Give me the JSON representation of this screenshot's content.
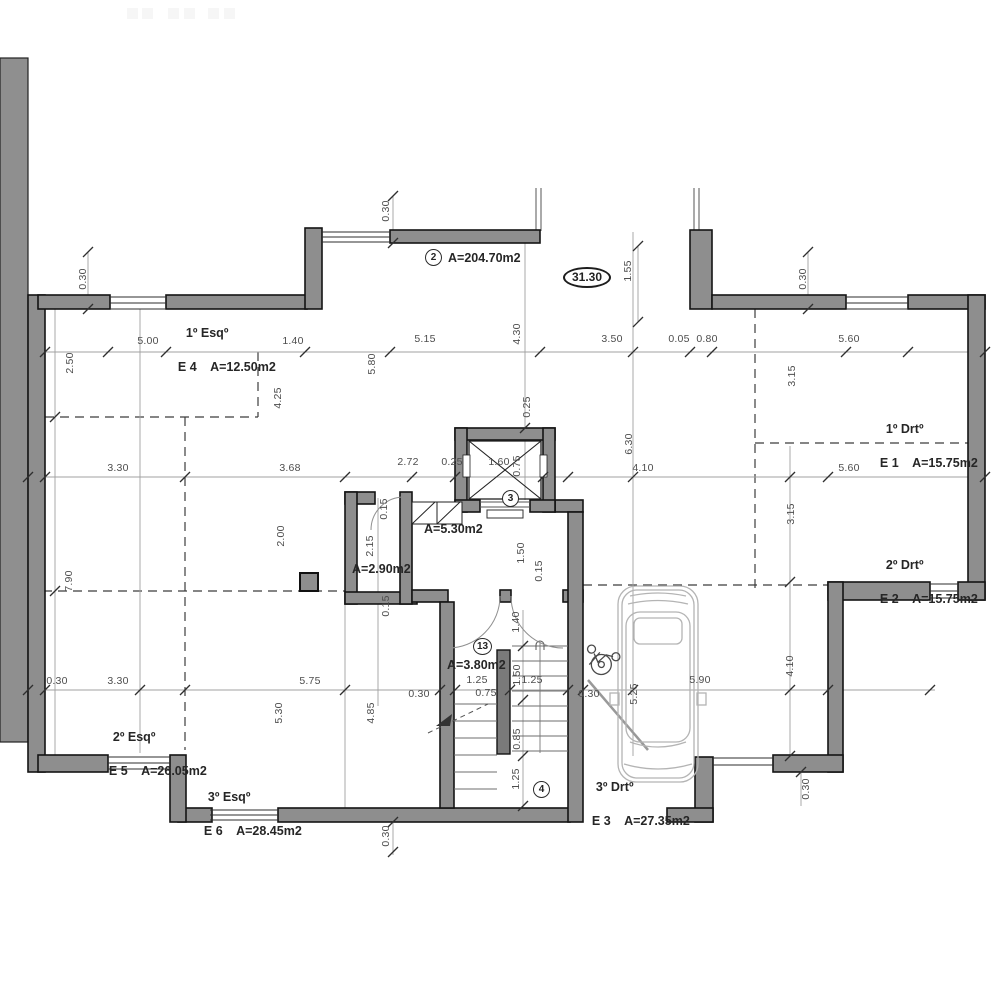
{
  "drawing": {
    "level_marker": "31.30",
    "zones": {
      "zone2": {
        "num": "2",
        "area": "A=204.70m2"
      },
      "zone3": {
        "num": "3"
      },
      "zone4": {
        "num": "4"
      },
      "zone13": {
        "num": "13",
        "area": "A=3.80m2"
      }
    },
    "rooms": {
      "hall": "A=5.30m2",
      "wc": "A=2.90m2"
    },
    "units": {
      "e1": {
        "floor": "1º Drtº",
        "label": "E 1    A=15.75m2"
      },
      "e2": {
        "floor": "2º Drtº",
        "label": "E 2    A=15.75m2"
      },
      "e3": {
        "floor": "3º Drtº",
        "label": "E 3    A=27.35m2"
      },
      "e4": {
        "floor": "1º Esqº",
        "label": "E 4    A=12.50m2"
      },
      "e5": {
        "floor": "2º Esqº",
        "label": "E 5    A=26.05m2"
      },
      "e6": {
        "floor": "3º Esqº",
        "label": "E 6    A=28.45m2"
      }
    },
    "dimensions": [
      {
        "t": "5.00",
        "x": 148,
        "y": 341
      },
      {
        "t": "1.40",
        "x": 293,
        "y": 341
      },
      {
        "t": "5.15",
        "x": 425,
        "y": 339
      },
      {
        "t": "3.50",
        "x": 612,
        "y": 339
      },
      {
        "t": "0.05",
        "x": 679,
        "y": 339
      },
      {
        "t": "0.80",
        "x": 707,
        "y": 339
      },
      {
        "t": "5.60",
        "x": 849,
        "y": 339
      },
      {
        "t": "3.30",
        "x": 118,
        "y": 468
      },
      {
        "t": "3.68",
        "x": 290,
        "y": 468
      },
      {
        "t": "2.72",
        "x": 408,
        "y": 462
      },
      {
        "t": "0.25",
        "x": 452,
        "y": 462
      },
      {
        "t": "1.60",
        "x": 499,
        "y": 462
      },
      {
        "t": "4.10",
        "x": 643,
        "y": 468
      },
      {
        "t": "5.60",
        "x": 849,
        "y": 468
      },
      {
        "t": "0.30",
        "x": 57,
        "y": 681
      },
      {
        "t": "3.30",
        "x": 118,
        "y": 681
      },
      {
        "t": "5.75",
        "x": 310,
        "y": 681
      },
      {
        "t": "0.30",
        "x": 419,
        "y": 694
      },
      {
        "t": "1.25",
        "x": 477,
        "y": 680
      },
      {
        "t": "0.75",
        "x": 486,
        "y": 693
      },
      {
        "t": "1.25",
        "x": 532,
        "y": 680
      },
      {
        "t": "0.30",
        "x": 589,
        "y": 694
      },
      {
        "t": "5.90",
        "x": 700,
        "y": 680
      },
      {
        "t": "0.30",
        "x": 83,
        "y": 279,
        "v": true
      },
      {
        "t": "0.30",
        "x": 386,
        "y": 211,
        "v": true
      },
      {
        "t": "1.55",
        "x": 628,
        "y": 271,
        "v": true
      },
      {
        "t": "0.30",
        "x": 803,
        "y": 279,
        "v": true
      },
      {
        "t": "2.50",
        "x": 70,
        "y": 363,
        "v": true
      },
      {
        "t": "5.80",
        "x": 372,
        "y": 364,
        "v": true
      },
      {
        "t": "4.25",
        "x": 278,
        "y": 398,
        "v": true
      },
      {
        "t": "4.30",
        "x": 517,
        "y": 334,
        "v": true
      },
      {
        "t": "3.15",
        "x": 792,
        "y": 376,
        "v": true
      },
      {
        "t": "0.25",
        "x": 527,
        "y": 407,
        "v": true
      },
      {
        "t": "6.30",
        "x": 629,
        "y": 444,
        "v": true
      },
      {
        "t": "0.75",
        "x": 517,
        "y": 466,
        "v": true
      },
      {
        "t": "3.15",
        "x": 791,
        "y": 514,
        "v": true
      },
      {
        "t": "0.15",
        "x": 384,
        "y": 509,
        "v": true
      },
      {
        "t": "2.15",
        "x": 370,
        "y": 546,
        "v": true
      },
      {
        "t": "2.00",
        "x": 281,
        "y": 536,
        "v": true
      },
      {
        "t": "1.50",
        "x": 521,
        "y": 553,
        "v": true
      },
      {
        "t": "0.15",
        "x": 539,
        "y": 571,
        "v": true
      },
      {
        "t": "7.90",
        "x": 69,
        "y": 581,
        "v": true
      },
      {
        "t": "0.15",
        "x": 386,
        "y": 606,
        "v": true
      },
      {
        "t": "1.40",
        "x": 516,
        "y": 622,
        "v": true
      },
      {
        "t": "5.25",
        "x": 634,
        "y": 694,
        "v": true
      },
      {
        "t": "5.30",
        "x": 279,
        "y": 713,
        "v": true
      },
      {
        "t": "4.85",
        "x": 371,
        "y": 713,
        "v": true
      },
      {
        "t": "1.50",
        "x": 517,
        "y": 675,
        "v": true
      },
      {
        "t": "0.85",
        "x": 517,
        "y": 739,
        "v": true
      },
      {
        "t": "1.25",
        "x": 516,
        "y": 779,
        "v": true
      },
      {
        "t": "4.10",
        "x": 790,
        "y": 666,
        "v": true
      },
      {
        "t": "0.30",
        "x": 806,
        "y": 789,
        "v": true
      },
      {
        "t": "0.30",
        "x": 386,
        "y": 836,
        "v": true
      }
    ],
    "colors": {
      "wall": "#8e8e8e",
      "outline": "#141414",
      "dim_text": "#4d4d4d"
    }
  }
}
